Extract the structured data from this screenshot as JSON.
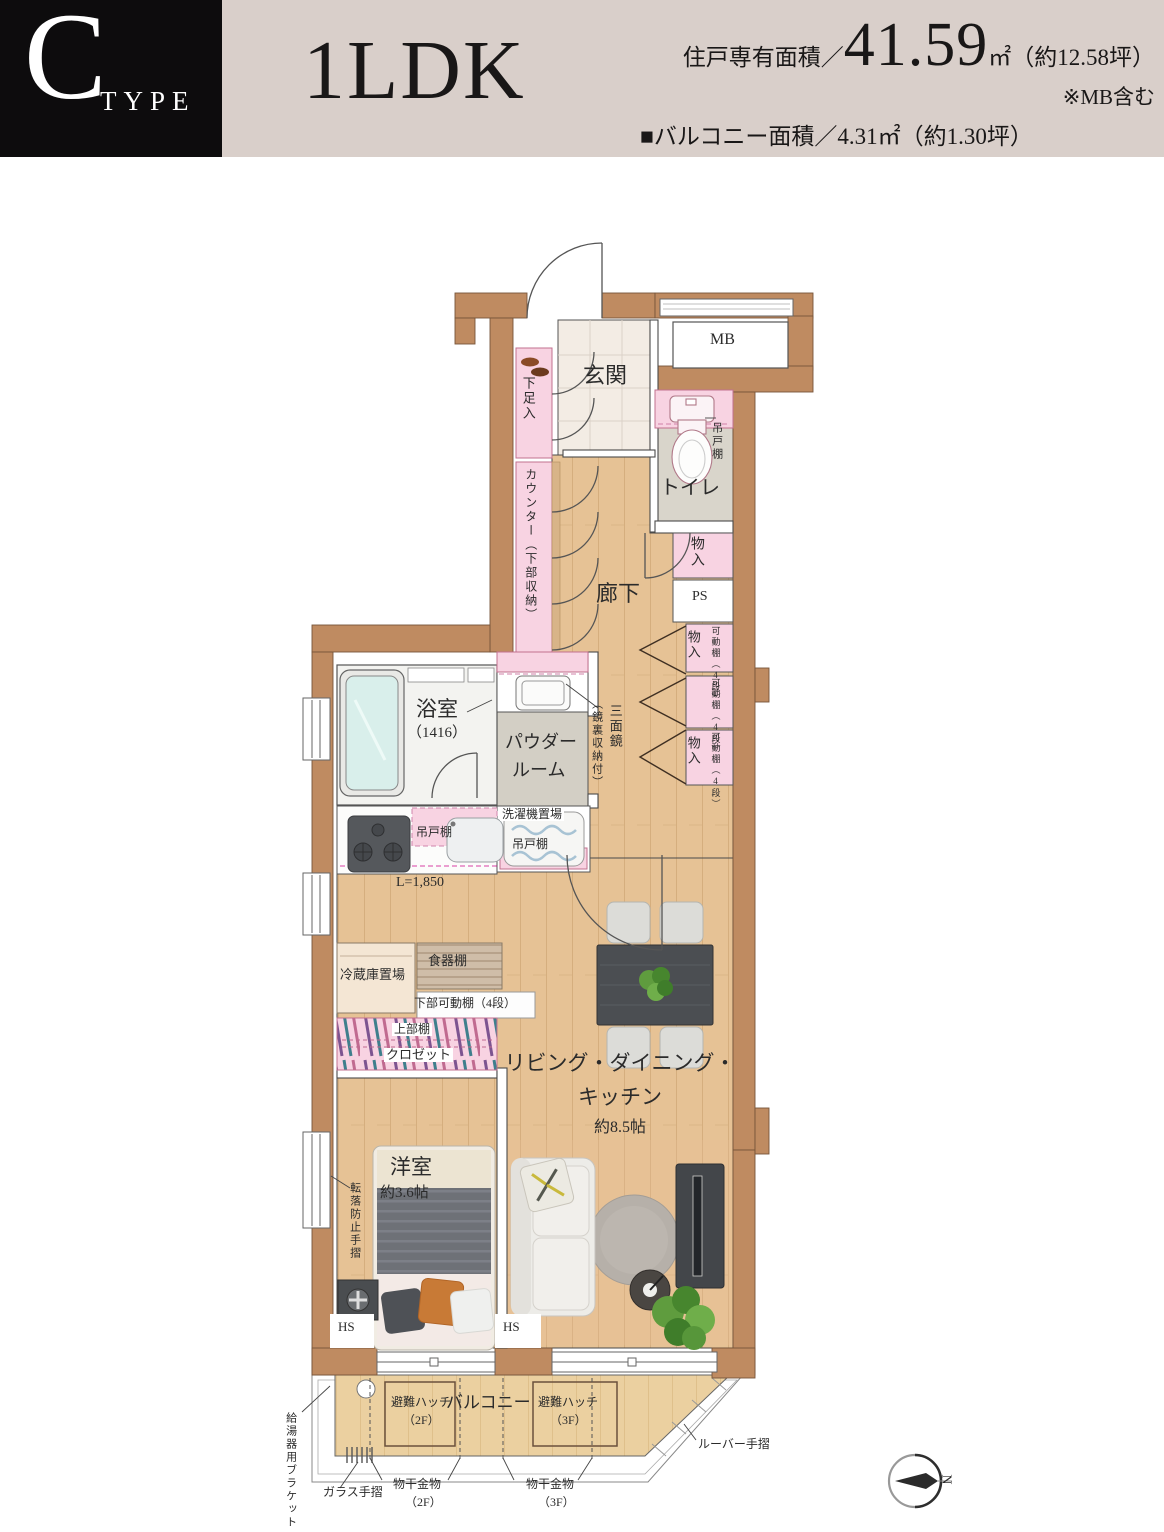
{
  "header": {
    "type_letter": "C",
    "type_word": "TYPE",
    "plan_name": "1LDK",
    "area_label": "住戸専有面積／",
    "area_value": "41.59",
    "area_unit": "㎡（約12.58坪）",
    "area_note": "※MB含む",
    "balcony_area": "■バルコニー面積／4.31㎡（約1.30坪）"
  },
  "labels": {
    "genkan": "玄関",
    "mb": "MB",
    "toilet": "トイレ",
    "tsuridana": "吊戸棚",
    "gesokuire": "下足入",
    "counter": "カウンター（下部収納）",
    "rouka": "廊下",
    "monoire": "物入",
    "ps": "PS",
    "kadodana": "可動棚（4段）",
    "sanmenkyo": "三面鏡",
    "sanmenkyo_sub": "（鏡裏収納付）",
    "bath": "浴室",
    "bath_size": "（1416）",
    "powder1": "パウダー",
    "powder2": "ルーム",
    "sentakuki": "洗濯機置場",
    "kitchen_length": "L=1,850",
    "reizouko": "冷蔵庫置場",
    "shokkidana": "食器棚",
    "kabudana": "下部可動棚（4段）",
    "joubudana": "上部棚",
    "closet": "クロゼット",
    "ldk_line1": "リビング・ダイニング・",
    "ldk_line2": "キッチン",
    "ldk_size": "約8.5帖",
    "yoshitsu": "洋室",
    "yoshitsu_size": "約3.6帖",
    "tenraku": "転落防止手摺",
    "hs": "HS",
    "balcony": "バルコニー",
    "hinan_hatch": "避難ハッチ",
    "floor2": "（2F）",
    "floor3": "（3F）",
    "monohoshi": "物干金物",
    "glass_rail": "ガラス手摺",
    "louver_rail": "ルーバー手摺",
    "kyutouki": "給湯器用ブラケット",
    "north": "N"
  },
  "colors": {
    "wall": "#bf8b61",
    "storage_pink": "#f8d3e2",
    "wood": "#e6c295",
    "accent_black": "#0d0c0d",
    "header_beige": "#d9cfca"
  }
}
